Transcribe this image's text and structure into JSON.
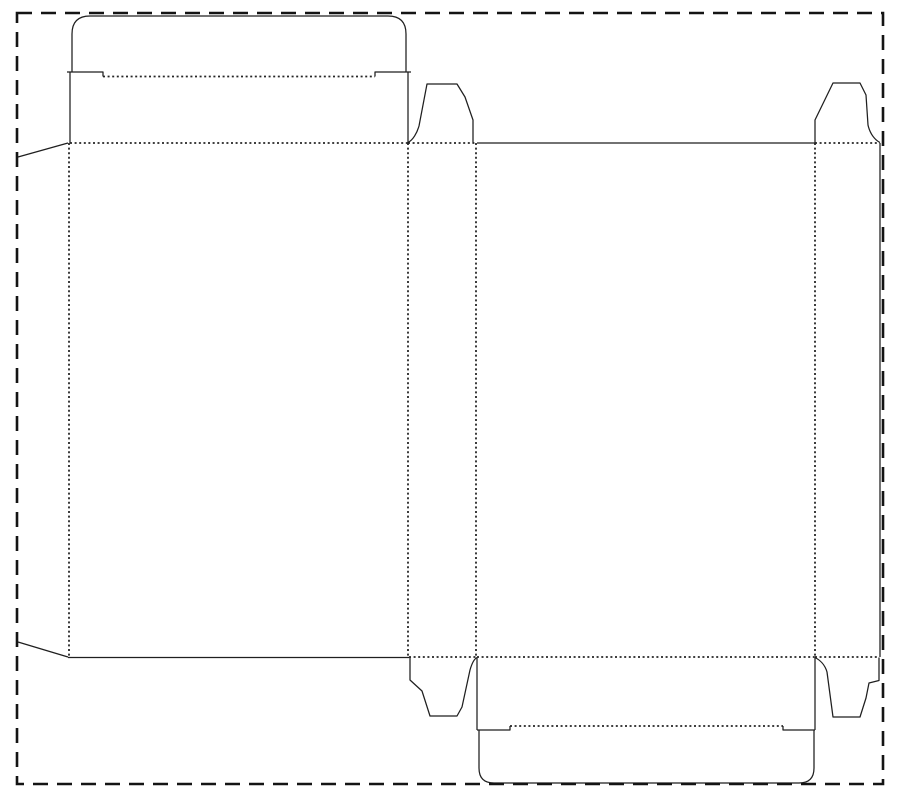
{
  "canvas": {
    "width": 900,
    "height": 800,
    "background": "#ffffff"
  },
  "styles": {
    "cut_color": "#1f1f1f",
    "cut_width": 1.25,
    "fold_color": "#262626",
    "fold_width": 1.8,
    "fold_dash": "2 2.6",
    "border_color": "#141414",
    "border_width": 2.6,
    "border_dash": "15 9"
  },
  "sheet_border": {
    "name": "sheet-boundary",
    "x": 17,
    "y": 13,
    "width": 866,
    "height": 771
  },
  "cut_lines": [
    {
      "name": "glue-flap-top-edge",
      "d": "M 68,143 L 18,157"
    },
    {
      "name": "glue-flap-bottom-edge",
      "d": "M 18,642 L 68,657"
    },
    {
      "name": "top-tuck-flap",
      "d": "M 72,72.5 L 72,34 Q 72,16 90,16 L 388,16 Q 406,16 406,34 L 406,72.5"
    },
    {
      "name": "top-tuck-shoulder-left",
      "d": "M 67,72 L 103,72 L 103,76.5"
    },
    {
      "name": "top-tuck-shoulder-right",
      "d": "M 375,76.5 L 375,72 L 411,72"
    },
    {
      "name": "lid-panel-left-edge",
      "d": "M 70,72 L 70,143"
    },
    {
      "name": "lid-panel-right-edge",
      "d": "M 408,72 L 408,143"
    },
    {
      "name": "front-panel-bottom-edge",
      "d": "M 68,657.5 L 409,657.5"
    },
    {
      "name": "dust-flap-top-left",
      "d": "M 408,142.5 C 413,140 417,133 419,126 L 427,84 L 457,84 L 465,97 L 473,120 L 473,142.5"
    },
    {
      "name": "dust-flap-top-right",
      "d": "M 815,142.5 L 815,120 L 833,83 L 860,83 L 866,95 L 868,125 C 870,134 875,140 880,142.5"
    },
    {
      "name": "back-panel-top-edge",
      "d": "M 477,143 L 815,143"
    },
    {
      "name": "side-panel-right-edge",
      "d": "M 880,143 L 880,657"
    },
    {
      "name": "dust-flap-bottom-left",
      "d": "M 410,657.5 L 410,680 L 422,691 L 430,716 L 457,716 L 462,707 L 470,670 C 472,663 474,659 477,657.5"
    },
    {
      "name": "dust-flap-bottom-right",
      "d": "M 815,657.5 C 820,660 825,665 827,672 L 833,717 L 860,717 L 866,698 L 869,683 L 879,680.5 L 879,657.5"
    },
    {
      "name": "bottom-panel-left-edge",
      "d": "M 477,657.5 L 477,730"
    },
    {
      "name": "bottom-panel-right-edge",
      "d": "M 815,657.5 L 815,730"
    },
    {
      "name": "bottom-tuck-shoulder-left",
      "d": "M 477,730 L 510,730 L 510,726"
    },
    {
      "name": "bottom-tuck-shoulder-right",
      "d": "M 783,726 L 783,730 L 815,730"
    },
    {
      "name": "bottom-tuck-flap",
      "d": "M 479,730 L 479,768 Q 479,783 494,783 L 799,783 Q 814,783 814,768 L 814,730"
    }
  ],
  "fold_lines": [
    {
      "name": "top-tuck-fold",
      "x1": 103,
      "y1": 76.5,
      "x2": 375,
      "y2": 76.5
    },
    {
      "name": "front-panel-top-fold",
      "x1": 70,
      "y1": 143,
      "x2": 408,
      "y2": 143
    },
    {
      "name": "dust-flap-top-left-fold",
      "x1": 408,
      "y1": 143,
      "x2": 476,
      "y2": 143
    },
    {
      "name": "dust-flap-top-right-fold",
      "x1": 815,
      "y1": 143,
      "x2": 880,
      "y2": 143
    },
    {
      "name": "glue-flap-fold",
      "x1": 69,
      "y1": 143,
      "x2": 69,
      "y2": 657
    },
    {
      "name": "front-side-fold",
      "x1": 408,
      "y1": 143,
      "x2": 408,
      "y2": 657
    },
    {
      "name": "side-back-fold",
      "x1": 476,
      "y1": 143,
      "x2": 476,
      "y2": 657
    },
    {
      "name": "back-side-fold",
      "x1": 815,
      "y1": 143,
      "x2": 815,
      "y2": 657
    },
    {
      "name": "dust-flap-bottom-left-fold",
      "x1": 409,
      "y1": 657,
      "x2": 477,
      "y2": 657
    },
    {
      "name": "back-panel-bottom-fold",
      "x1": 477,
      "y1": 657,
      "x2": 815,
      "y2": 657
    },
    {
      "name": "dust-flap-bottom-right-fold",
      "x1": 815,
      "y1": 657,
      "x2": 879,
      "y2": 657
    },
    {
      "name": "bottom-tuck-fold",
      "x1": 510,
      "y1": 726,
      "x2": 783,
      "y2": 726
    }
  ]
}
